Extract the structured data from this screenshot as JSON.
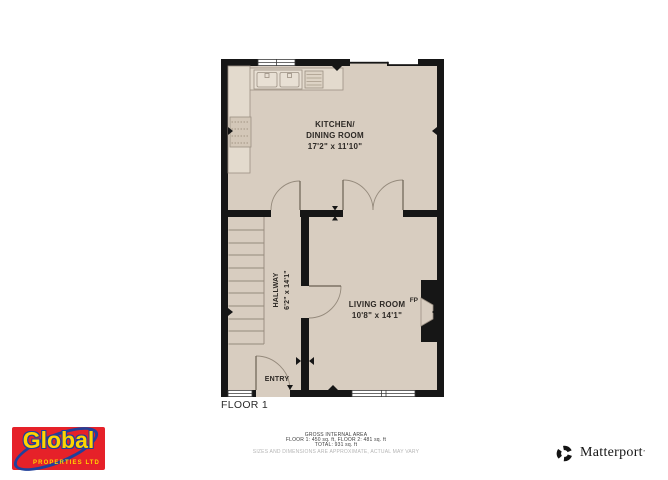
{
  "plan": {
    "floor_label": "FLOOR 1",
    "kitchen": {
      "line1": "KITCHEN/",
      "line2": "DINING ROOM",
      "dims": "17'2\" x 11'10\""
    },
    "living": {
      "name": "LIVING ROOM",
      "dims": "10'8\" x 14'1\""
    },
    "hallway": {
      "name": "HALLWAY",
      "dims": "6'2\" x 14'1\""
    },
    "entry_label": "ENTRY",
    "fireplace_label": "FP"
  },
  "footer": {
    "title": "GROSS INTERNAL AREA",
    "line1": "FLOOR 1: 450 sq. ft, FLOOR 2: 481 sq. ft",
    "line2": "TOTAL: 931 sq. ft",
    "disclaimer": "SIZES AND DIMENSIONS ARE APPROXIMATE, ACTUAL MAY VARY"
  },
  "branding": {
    "agency_name": "Global",
    "agency_subtitle": "PROPERTIES LTD",
    "matterport_name": "Matterport",
    "matterport_mark": "’"
  },
  "colors": {
    "wall": "#161616",
    "floor": "#d8cdc0",
    "counter": "#e3dacd",
    "logo_red": "#e62129",
    "logo_yellow": "#ffd400",
    "logo_blue": "#20409a"
  }
}
